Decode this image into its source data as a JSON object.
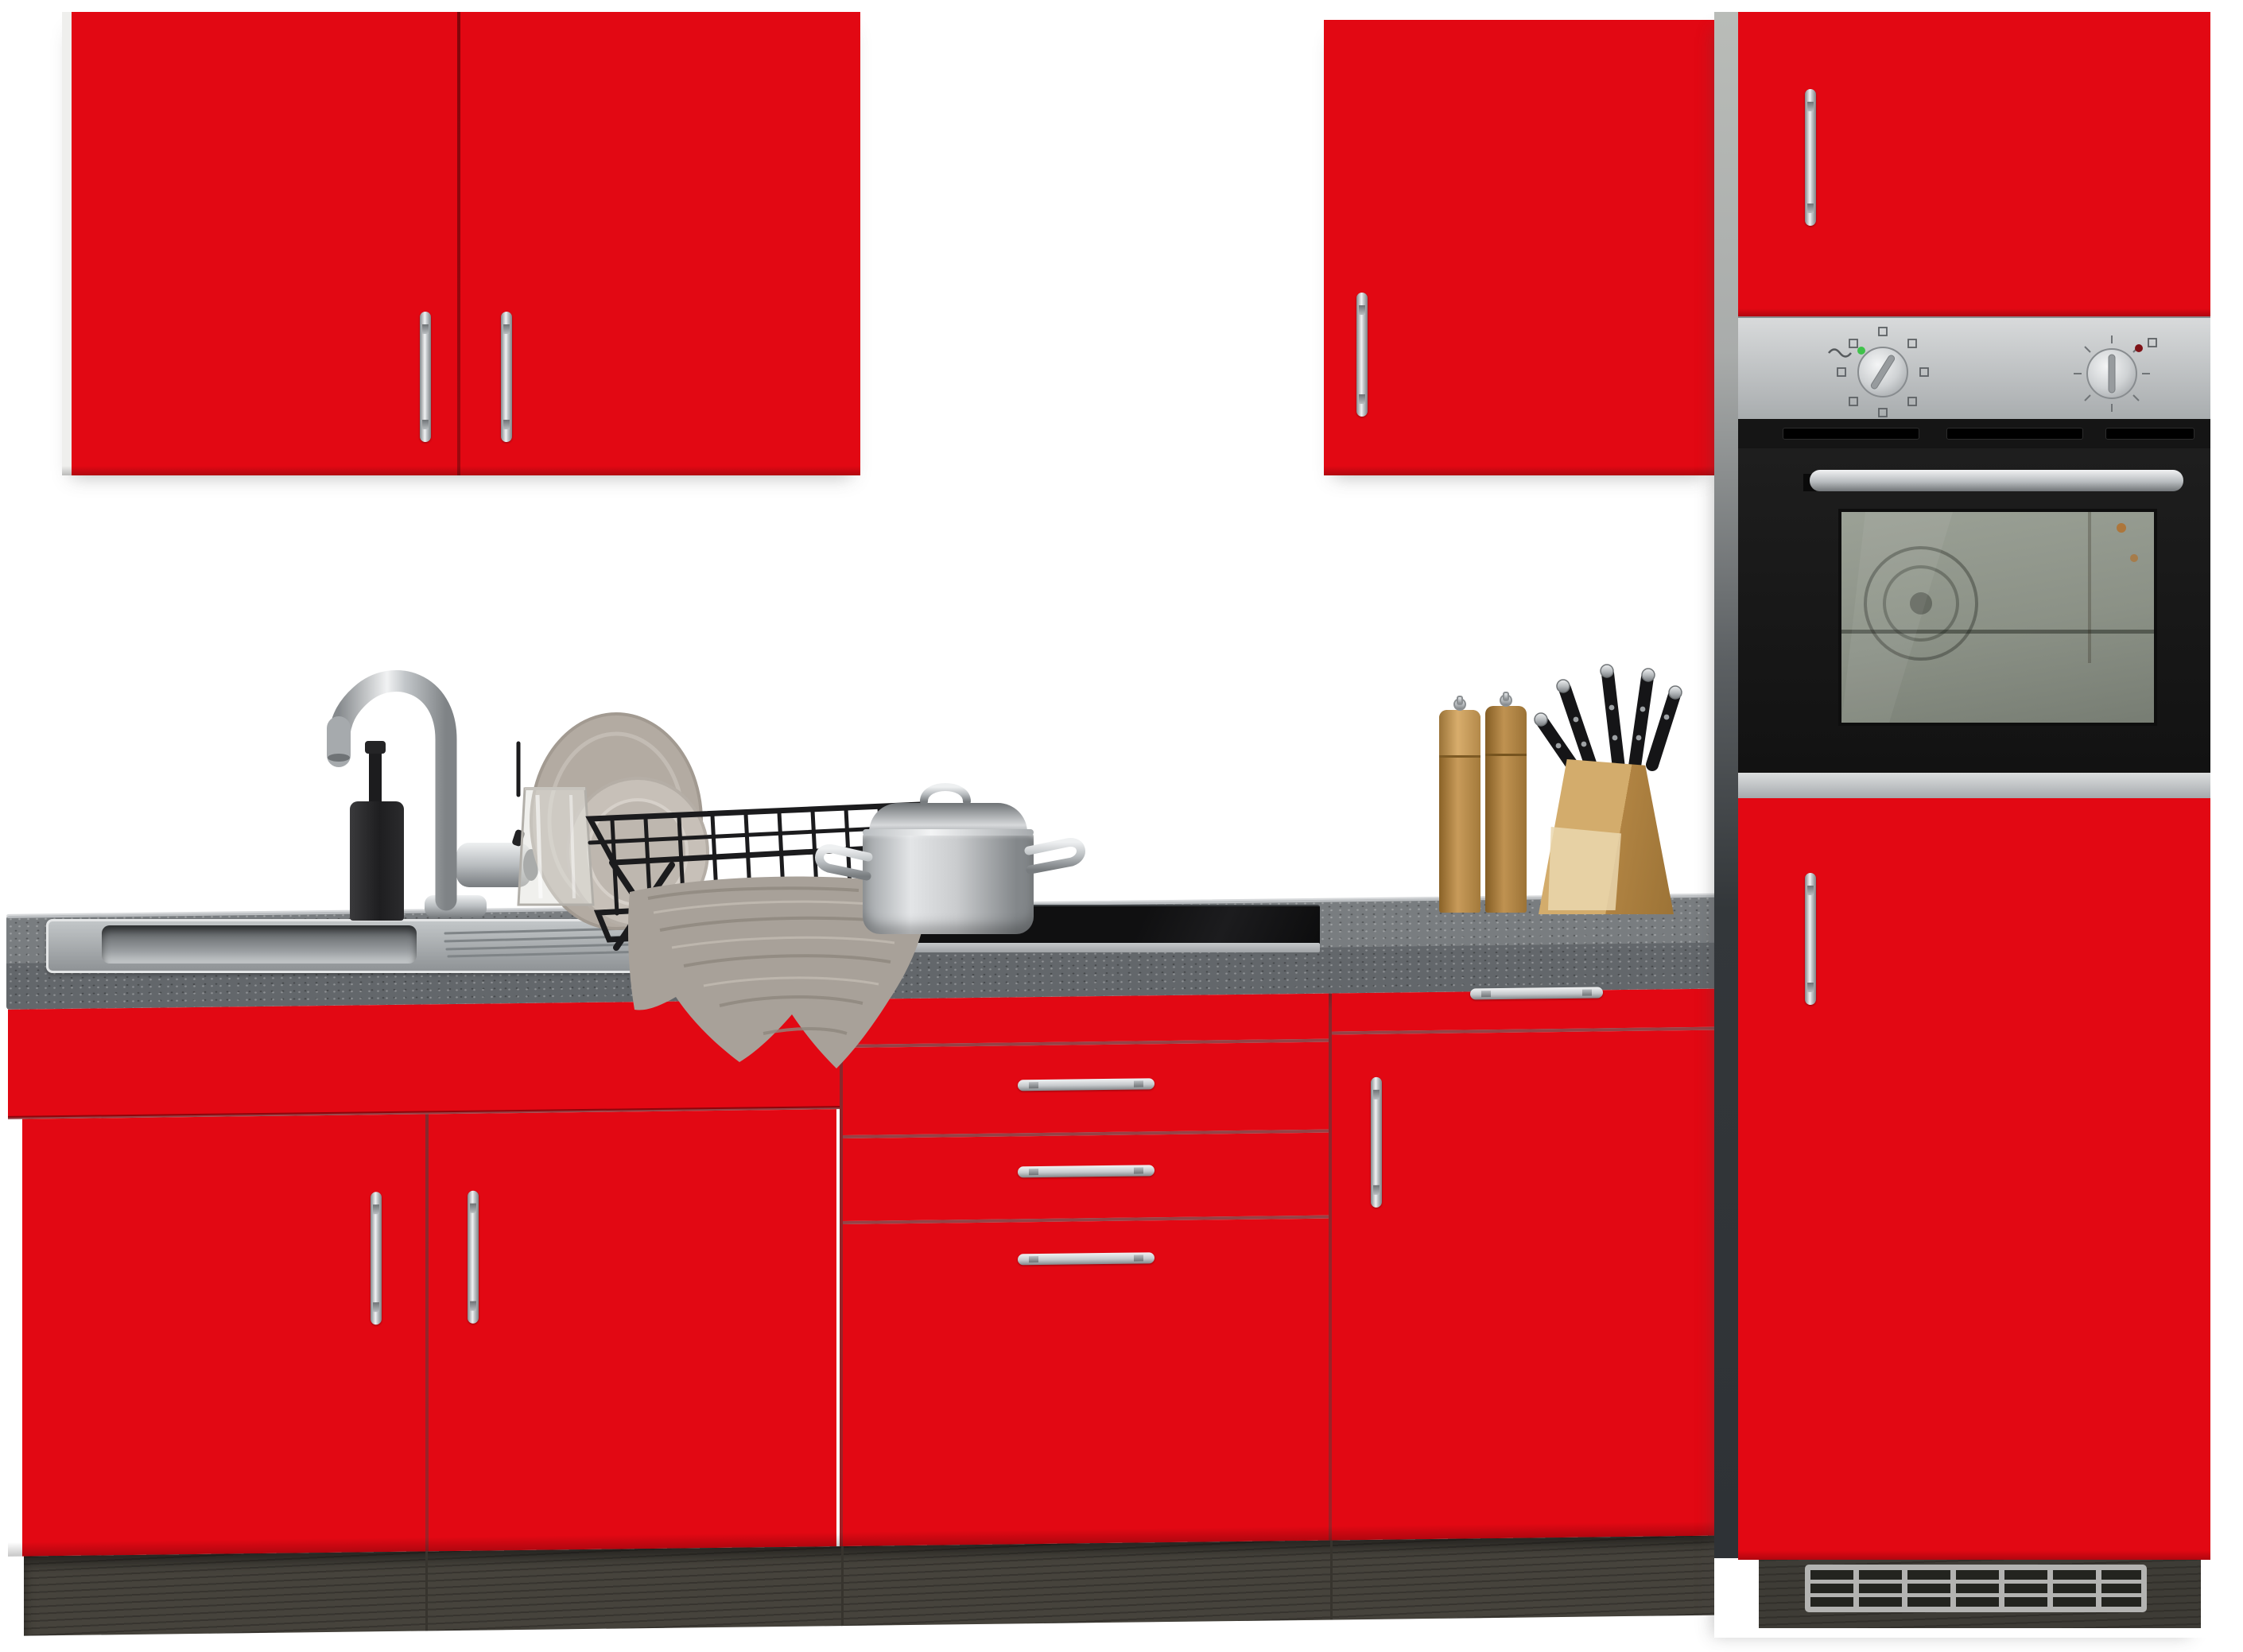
{
  "meta": {
    "type": "product-photo",
    "subject": "Red fitted kitchen unit with oven tower, sink run, cooktop and accessories",
    "background": "#ffffff",
    "text_content": "none (image contains no readable text)"
  },
  "colors": {
    "white": "#ffffff",
    "red": "#e20813",
    "red-shade": "#c00710",
    "red-line": "#8f060d",
    "counter-top": "#797d80",
    "counter-front": "#63676b",
    "counter-edge": "#cdd0d2",
    "plinth": "#46433c",
    "plinth-dark": "#37342e",
    "panel-light": "#b8bbb7",
    "panel-dark": "#303438",
    "steel-light": "#d6d8da",
    "steel-dark": "#a6aaad",
    "oven-black": "#171717",
    "sage": "#949a8e",
    "sage-dark": "#767c71",
    "chrome-light": "#f1f2f3",
    "chrome-dark": "#84888b",
    "towel": "#a8a199",
    "towel-dark": "#918a80",
    "towel-light": "#c0b9b0",
    "plate": "#b3aba2",
    "plate-light": "#c7c0b8",
    "wood": "#c89b5a",
    "wood-dark": "#a37a3b",
    "wood-pale": "#ead7ae",
    "matte-black": "#202022",
    "led-green": "#3fc24a",
    "led-red": "#7e1216",
    "grille": "#b3b3b1",
    "grille-slot": "#23241f"
  },
  "kitchen": {
    "wall_cabinet_left": {
      "doors": 2,
      "handles": "2 vertical chrome bars"
    },
    "wall_cabinet_right": {
      "doors": 1,
      "handles": "1 vertical chrome bar"
    },
    "tall_unit": {
      "top_door": "red, chrome handle left",
      "oven": {
        "control_panel": "stainless, 2 knobs, green + red indicator lights",
        "door": "black glass with stainless handle bar and sage window",
        "trim": "stainless strip below door"
      },
      "lower_door": "red, chrome handle left",
      "plinth": "dark with ventilation grille 3 rows x 7 slots"
    },
    "base_run": {
      "countertop": "dark grey speckled stone-look",
      "sink_cabinet": {
        "front": "blank apron + 2 doors",
        "handles": "2 vertical chrome bars"
      },
      "drawer_unit": {
        "fronts": "1 blank + 3 drawers",
        "handles": "3 horizontal chrome bars"
      },
      "right_cabinet": {
        "fronts": "1 drawer + 1 door",
        "handles": "1 horizontal + 1 vertical chrome bar"
      },
      "plinth": "dark grey wood-grain"
    },
    "accessories": [
      "stainless inset sink",
      "chrome gooseneck faucet",
      "black soap dispenser",
      "black wire dish rack",
      "two beige plates",
      "glass tumbler",
      "grey kitchen towel",
      "stainless pot with lid",
      "black glass cooktop",
      "two wooden spice mills",
      "wooden knife block with five knives"
    ]
  }
}
